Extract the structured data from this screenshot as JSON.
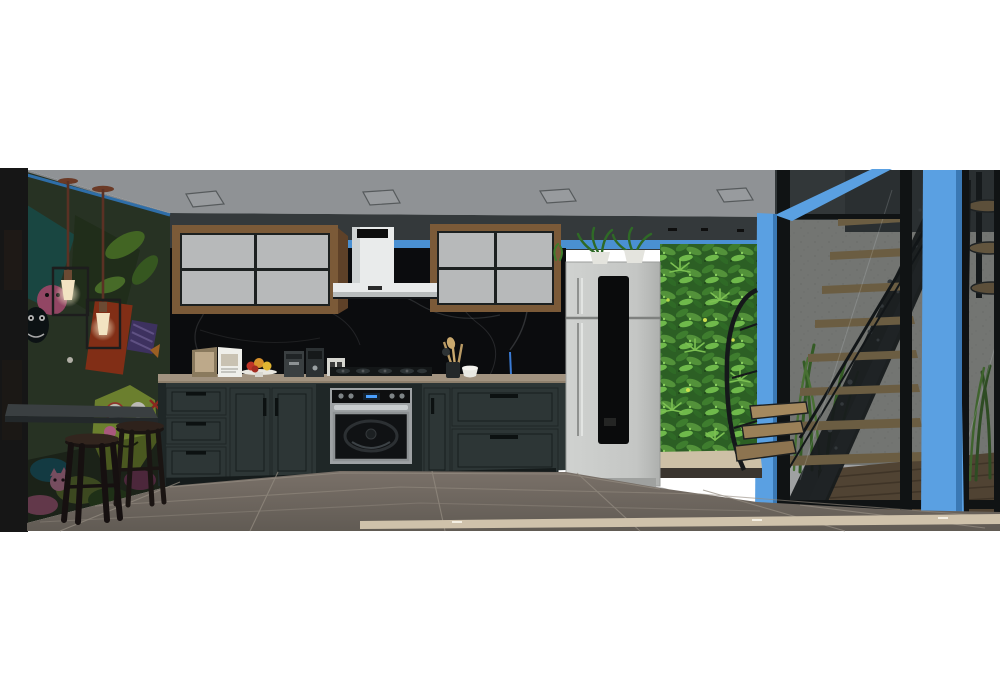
{
  "scene": {
    "type": "3d-architectural-rendering",
    "description": "SketchUp-style 3D rendering of an industrial loft kitchen: graffiti mural wall with caged pendant lights and bar stools on the left; charcoal shaker cabinets, wood-framed upper cabinets, white chimney range hood, black marble backsplash, built-in oven and white refrigerator in the center; vertical green living wall; bright blue structural columns and a glazed wall with a black steel staircase, spiral stair and tall grasses on the right; grey tile floor; white letterbox bars above and below."
  },
  "colors": {
    "ceiling": "#8f9295",
    "ceiling_line": "#55585a",
    "ceiling_light_fill": "#9a9da0",
    "soffit": "#34393b",
    "accent_blue": "#4a90d2",
    "accent_blue_bright": "#5aa0e2",
    "mural_base": "#33402e",
    "backsplash": "#0b0c0e",
    "marble_vein": "#caccd2",
    "cabinet": "#2d3636",
    "cabinet_dark": "#1f2727",
    "handle_black": "#0c1111",
    "wood_frame": "#7b5a38",
    "wood_frame_dark": "#5e4128",
    "panel_gray": "#b7b9ba",
    "hood_white": "#e9ebeb",
    "counter": "#a29380",
    "fridge": "#c7c9c7",
    "fridge_panel": "#0a0b0c",
    "greenwall": "#35702b",
    "green_light": "#63aa3f",
    "green_dark": "#234d1c",
    "concrete": "#b6b6b0",
    "floor": "#6e6760",
    "grout": "#938b80",
    "threshold": "#cfc2ab",
    "stair_black": "#1c1f20",
    "tread_wood": "#a98e60",
    "deck": "#7c6347",
    "stool": "#1a1412",
    "stone_curb": "#cdc0a6",
    "bulb_warm": "#f2e3c2",
    "glass_tint": "rgba(14,20,23,0.40)"
  },
  "objects": {
    "ceiling_lights_count": 4,
    "pendant_lights_count": 2,
    "bar_stools_count": 2,
    "upper_cabinet_panels": "2x2 grey panels in wood frames",
    "range_hood_label": "small dark brand label (illegible)",
    "countertop_items": [
      "open cookbook on stand",
      "fruit plate on cake stand",
      "espresso machine",
      "coffee grinder",
      "small white appliance",
      "utensil crock with wooden spoons",
      "white bowl"
    ],
    "refrigerator": "white top-freezer with black center glass strip and left pole handle",
    "right_side": [
      "green living wall",
      "blue columns",
      "glazed wall",
      "perforated steel stair with wood treads",
      "spiral staircase",
      "tall grasses",
      "wood deck"
    ]
  }
}
